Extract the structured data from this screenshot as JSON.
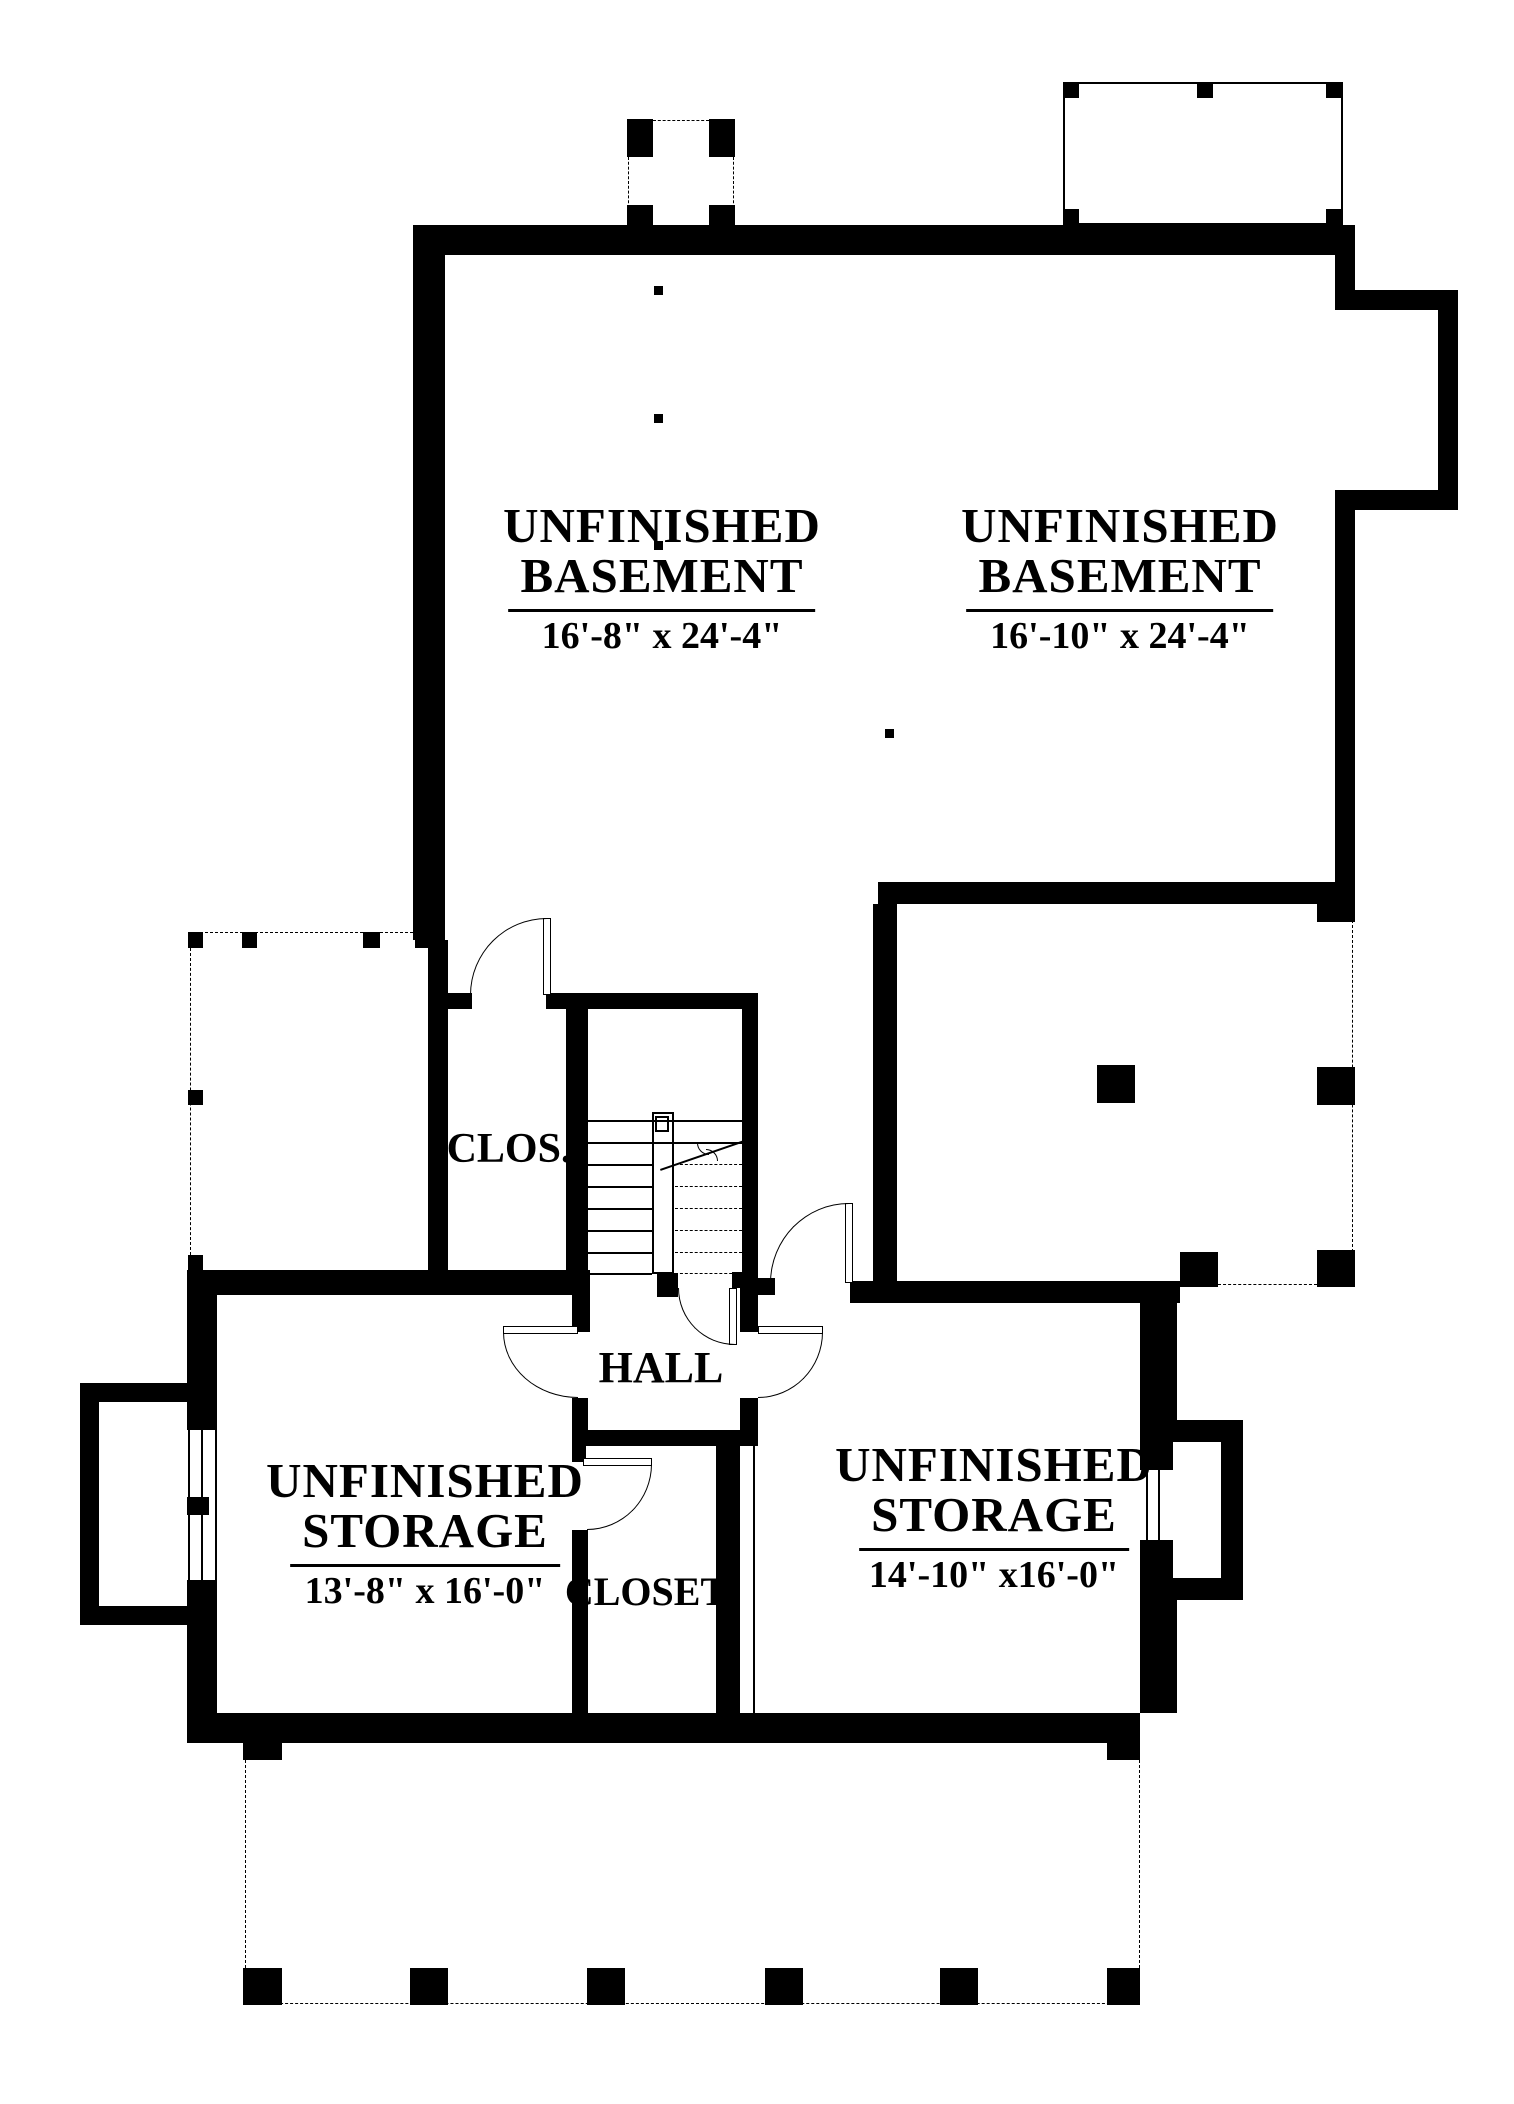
{
  "page": {
    "background": "#ffffff",
    "ink_color": "#000000",
    "type": "basement floor plan drawing"
  },
  "labels": [
    {
      "n": "room-label-basement-left",
      "cx": 662,
      "top": 501,
      "fs": 49,
      "line1": "UNFINISHED",
      "line2": "BASEMENT",
      "dims": "16'-8\" x 24'-4\""
    },
    {
      "n": "room-label-basement-right",
      "cx": 1120,
      "top": 501,
      "fs": 49,
      "line1": "UNFINISHED",
      "line2": "BASEMENT",
      "dims": "16'-10\" x 24'-4\""
    },
    {
      "n": "room-label-storage-left",
      "cx": 425,
      "top": 1456,
      "fs": 49,
      "line1": "UNFINISHED",
      "line2": "STORAGE",
      "dims": "13'-8\" x 16'-0\""
    },
    {
      "n": "room-label-storage-right",
      "cx": 994,
      "top": 1440,
      "fs": 49,
      "line1": "UNFINISHED",
      "line2": "STORAGE",
      "dims": "14'-10\" x16'-0\""
    }
  ],
  "small_labels": [
    {
      "n": "room-label-clos",
      "cx": 509,
      "top": 1125,
      "fs": 42,
      "text": "CLOS."
    },
    {
      "n": "room-label-hall",
      "cx": 661,
      "top": 1342,
      "fs": 44,
      "text": "HALL"
    },
    {
      "n": "room-label-closet",
      "cx": 646,
      "top": 1568,
      "fs": 40,
      "text": "CLOSET"
    }
  ],
  "shapes": [
    {
      "t": "wall",
      "n": "wall-top",
      "x": 413,
      "y": 225,
      "w": 942,
      "h": 30
    },
    {
      "t": "wall",
      "n": "wall-west-upper",
      "x": 413,
      "y": 225,
      "w": 32,
      "h": 715
    },
    {
      "t": "wall",
      "n": "wall-west-mid",
      "x": 428,
      "y": 940,
      "w": 20,
      "h": 353
    },
    {
      "t": "wall",
      "n": "wall-east-upper",
      "x": 1335,
      "y": 225,
      "w": 20,
      "h": 85
    },
    {
      "t": "wall",
      "n": "wall-east-bump-top",
      "x": 1335,
      "y": 290,
      "w": 123,
      "h": 20
    },
    {
      "t": "wall",
      "n": "wall-east-bump-right",
      "x": 1438,
      "y": 290,
      "w": 20,
      "h": 220
    },
    {
      "t": "wall",
      "n": "wall-east-bump-bottom",
      "x": 1352,
      "y": 490,
      "w": 106,
      "h": 20
    },
    {
      "t": "wall",
      "n": "wall-east-mid",
      "x": 1335,
      "y": 490,
      "w": 20,
      "h": 430
    },
    {
      "t": "wall",
      "n": "wall-basement-south",
      "x": 878,
      "y": 882,
      "w": 477,
      "h": 22
    },
    {
      "t": "wall",
      "n": "wall-lowerright-west",
      "x": 873,
      "y": 904,
      "w": 24,
      "h": 380
    },
    {
      "t": "wall",
      "n": "wall-storage-right-north",
      "x": 850,
      "y": 1281,
      "w": 330,
      "h": 22
    },
    {
      "t": "wall",
      "n": "wall-stair-top-a",
      "x": 428,
      "y": 993,
      "w": 44,
      "h": 16
    },
    {
      "t": "wall",
      "n": "wall-stair-top-b",
      "x": 546,
      "y": 993,
      "w": 212,
      "h": 16
    },
    {
      "t": "wall",
      "n": "wall-clos-east",
      "x": 566,
      "y": 1009,
      "w": 22,
      "h": 266
    },
    {
      "t": "wall",
      "n": "wall-stairwell-east",
      "x": 742,
      "y": 1009,
      "w": 16,
      "h": 266
    },
    {
      "t": "wall",
      "n": "wall-storage-left-north",
      "x": 187,
      "y": 1270,
      "w": 403,
      "h": 25
    },
    {
      "t": "wall",
      "n": "wall-stair-stub-mid",
      "x": 657,
      "y": 1273,
      "w": 21,
      "h": 24
    },
    {
      "t": "wall",
      "n": "wall-stair-stub-right",
      "x": 732,
      "y": 1272,
      "w": 26,
      "h": 16
    },
    {
      "t": "wall",
      "n": "wall-stub-hall-ne",
      "x": 758,
      "y": 1278,
      "w": 17,
      "h": 17
    },
    {
      "t": "wall",
      "n": "wall-hall-west-a",
      "x": 572,
      "y": 1295,
      "w": 18,
      "h": 37
    },
    {
      "t": "wall",
      "n": "wall-hall-west-b",
      "x": 572,
      "y": 1398,
      "w": 16,
      "h": 47
    },
    {
      "t": "wall",
      "n": "wall-closet-west-stub",
      "x": 572,
      "y": 1445,
      "w": 14,
      "h": 17
    },
    {
      "t": "wall",
      "n": "wall-closet-west",
      "x": 572,
      "y": 1530,
      "w": 16,
      "h": 185
    },
    {
      "t": "wall",
      "n": "wall-closet-north",
      "x": 580,
      "y": 1430,
      "w": 175,
      "h": 16
    },
    {
      "t": "wall",
      "n": "wall-closet-east",
      "x": 716,
      "y": 1446,
      "w": 24,
      "h": 270
    },
    {
      "t": "wall",
      "n": "wall-storage-right-west-a",
      "x": 740,
      "y": 1288,
      "w": 18,
      "h": 44
    },
    {
      "t": "wall",
      "n": "wall-storage-right-west-b",
      "x": 740,
      "y": 1398,
      "w": 18,
      "h": 48
    },
    {
      "t": "wall",
      "n": "wall-storage-right-east-a",
      "x": 1140,
      "y": 1303,
      "w": 37,
      "h": 117
    },
    {
      "t": "wall",
      "n": "wall-storage-right-east-b",
      "x": 1140,
      "y": 1600,
      "w": 37,
      "h": 113
    },
    {
      "t": "wall",
      "n": "wall-bottom",
      "x": 187,
      "y": 1713,
      "w": 953,
      "h": 30
    },
    {
      "t": "wall",
      "n": "wall-storage-left-west-a",
      "x": 187,
      "y": 1272,
      "w": 30,
      "h": 158
    },
    {
      "t": "wall",
      "n": "wall-storage-left-west-b",
      "x": 187,
      "y": 1580,
      "w": 30,
      "h": 133
    },
    {
      "t": "wall",
      "n": "wall-leftbump-top",
      "x": 80,
      "y": 1383,
      "w": 137,
      "h": 19
    },
    {
      "t": "wall",
      "n": "wall-leftbump-left",
      "x": 80,
      "y": 1383,
      "w": 19,
      "h": 242
    },
    {
      "t": "wall",
      "n": "wall-leftbump-bottom",
      "x": 80,
      "y": 1606,
      "w": 137,
      "h": 19
    },
    {
      "t": "wall",
      "n": "wall-rightbump-top",
      "x": 1140,
      "y": 1420,
      "w": 103,
      "h": 22
    },
    {
      "t": "wall",
      "n": "wall-rightbump-right",
      "x": 1221,
      "y": 1420,
      "w": 22,
      "h": 180
    },
    {
      "t": "wall",
      "n": "wall-rightbump-bottom",
      "x": 1140,
      "y": 1578,
      "w": 103,
      "h": 22
    },
    {
      "t": "wall",
      "n": "wall-rightbump-left-a",
      "x": 1140,
      "y": 1420,
      "w": 33,
      "h": 50
    },
    {
      "t": "wall",
      "n": "wall-rightbump-left-b",
      "x": 1140,
      "y": 1540,
      "w": 33,
      "h": 60
    },
    {
      "t": "wall",
      "n": "window-mullion-left",
      "x": 187,
      "y": 1497,
      "w": 22,
      "h": 18
    },
    {
      "t": "post",
      "n": "stoop-post-nw",
      "x": 627,
      "y": 119,
      "w": 26,
      "h": 38
    },
    {
      "t": "post",
      "n": "stoop-post-ne",
      "x": 709,
      "y": 119,
      "w": 26,
      "h": 38
    },
    {
      "t": "post",
      "n": "stoop-post-sw",
      "x": 627,
      "y": 205,
      "w": 26,
      "h": 22
    },
    {
      "t": "post",
      "n": "stoop-post-se",
      "x": 709,
      "y": 205,
      "w": 26,
      "h": 22
    },
    {
      "t": "post",
      "n": "trporch-post-nw",
      "x": 1063,
      "y": 82,
      "w": 16,
      "h": 16
    },
    {
      "t": "post",
      "n": "trporch-post-n",
      "x": 1197,
      "y": 82,
      "w": 16,
      "h": 16
    },
    {
      "t": "post",
      "n": "trporch-post-ne",
      "x": 1326,
      "y": 82,
      "w": 16,
      "h": 16
    },
    {
      "t": "post",
      "n": "trporch-post-sw",
      "x": 1063,
      "y": 209,
      "w": 16,
      "h": 16
    },
    {
      "t": "post",
      "n": "trporch-post-se",
      "x": 1326,
      "y": 209,
      "w": 16,
      "h": 16
    },
    {
      "t": "post",
      "n": "lporch-post-1",
      "x": 188,
      "y": 932,
      "w": 15,
      "h": 16
    },
    {
      "t": "post",
      "n": "lporch-post-2",
      "x": 242,
      "y": 932,
      "w": 15,
      "h": 16
    },
    {
      "t": "post",
      "n": "lporch-post-3",
      "x": 363,
      "y": 932,
      "w": 17,
      "h": 16
    },
    {
      "t": "post",
      "n": "lporch-post-4",
      "x": 415,
      "y": 932,
      "w": 15,
      "h": 16
    },
    {
      "t": "post",
      "n": "lporch-post-5",
      "x": 188,
      "y": 1090,
      "w": 15,
      "h": 15
    },
    {
      "t": "post",
      "n": "lporch-post-6",
      "x": 188,
      "y": 1255,
      "w": 15,
      "h": 17
    },
    {
      "t": "post",
      "n": "rporch-post-n",
      "x": 1317,
      "y": 898,
      "w": 38,
      "h": 24
    },
    {
      "t": "post",
      "n": "rporch-post-e",
      "x": 1317,
      "y": 1067,
      "w": 38,
      "h": 38
    },
    {
      "t": "post",
      "n": "rporch-post-se",
      "x": 1317,
      "y": 1250,
      "w": 38,
      "h": 37
    },
    {
      "t": "post",
      "n": "rporch-post-s",
      "x": 1180,
      "y": 1252,
      "w": 38,
      "h": 35
    },
    {
      "t": "post",
      "n": "column-post",
      "x": 1097,
      "y": 1065,
      "w": 38,
      "h": 38
    },
    {
      "t": "post",
      "n": "bporch-post-nw",
      "x": 243,
      "y": 1743,
      "w": 39,
      "h": 17
    },
    {
      "t": "post",
      "n": "bporch-post-ne",
      "x": 1107,
      "y": 1743,
      "w": 33,
      "h": 17
    },
    {
      "t": "post",
      "n": "bporch-post-s1",
      "x": 243,
      "y": 1968,
      "w": 39,
      "h": 37
    },
    {
      "t": "post",
      "n": "bporch-post-s2",
      "x": 410,
      "y": 1968,
      "w": 38,
      "h": 37
    },
    {
      "t": "post",
      "n": "bporch-post-s3",
      "x": 587,
      "y": 1968,
      "w": 38,
      "h": 37
    },
    {
      "t": "post",
      "n": "bporch-post-s4",
      "x": 765,
      "y": 1968,
      "w": 38,
      "h": 37
    },
    {
      "t": "post",
      "n": "bporch-post-s5",
      "x": 940,
      "y": 1968,
      "w": 38,
      "h": 37
    },
    {
      "t": "post",
      "n": "bporch-post-s6",
      "x": 1107,
      "y": 1968,
      "w": 33,
      "h": 37
    },
    {
      "t": "dot",
      "n": "column-dot-1",
      "x": 654,
      "y": 286,
      "w": 9,
      "h": 9
    },
    {
      "t": "dot",
      "n": "column-dot-2",
      "x": 654,
      "y": 414,
      "w": 9,
      "h": 9
    },
    {
      "t": "dot",
      "n": "column-dot-3",
      "x": 654,
      "y": 541,
      "w": 9,
      "h": 9
    },
    {
      "t": "dot",
      "n": "column-dot-4",
      "x": 885,
      "y": 729,
      "w": 9,
      "h": 9
    },
    {
      "t": "dashh",
      "n": "stoop-dash-top",
      "x": 653,
      "y": 120,
      "w": 56,
      "h": 0
    },
    {
      "t": "dashv",
      "n": "stoop-dash-left",
      "x": 628,
      "y": 157,
      "w": 0,
      "h": 51
    },
    {
      "t": "dashv",
      "n": "stoop-dash-right",
      "x": 733,
      "y": 157,
      "w": 0,
      "h": 51
    },
    {
      "t": "dashh",
      "n": "lporch-dash-top",
      "x": 190,
      "y": 932,
      "w": 238,
      "h": 0
    },
    {
      "t": "dashv",
      "n": "lporch-dash-left",
      "x": 190,
      "y": 948,
      "w": 0,
      "h": 307
    },
    {
      "t": "dashv",
      "n": "rporch-dash-east",
      "x": 1352,
      "y": 920,
      "w": 0,
      "h": 332
    },
    {
      "t": "dashh",
      "n": "rporch-dash-south",
      "x": 1218,
      "y": 1284,
      "w": 99,
      "h": 0
    },
    {
      "t": "dashv",
      "n": "bporch-dash-west",
      "x": 245,
      "y": 1760,
      "w": 0,
      "h": 243
    },
    {
      "t": "dashh",
      "n": "bporch-dash-south",
      "x": 245,
      "y": 2003,
      "w": 895,
      "h": 0
    },
    {
      "t": "dashv",
      "n": "bporch-dash-east",
      "x": 1139,
      "y": 1760,
      "w": 0,
      "h": 208
    },
    {
      "t": "thinrect",
      "n": "trporch-outline",
      "x": 1063,
      "y": 82,
      "w": 280,
      "h": 143
    },
    {
      "t": "thinrect",
      "n": "stair-rail",
      "x": 652,
      "y": 1112,
      "w": 22,
      "h": 162
    },
    {
      "t": "thinrect",
      "n": "stair-rail-cap",
      "x": 655,
      "y": 1116,
      "w": 14,
      "h": 16
    },
    {
      "t": "lineh",
      "n": "stair-tread-1",
      "x": 588,
      "y": 1120,
      "w": 154,
      "h": 0
    },
    {
      "t": "lineh",
      "n": "stair-tread-2",
      "x": 588,
      "y": 1142,
      "w": 154,
      "h": 0
    },
    {
      "t": "lineh",
      "n": "stair-tread-3",
      "x": 588,
      "y": 1164,
      "w": 64,
      "h": 0
    },
    {
      "t": "lineh",
      "n": "stair-tread-4",
      "x": 588,
      "y": 1186,
      "w": 64,
      "h": 0
    },
    {
      "t": "lineh",
      "n": "stair-tread-5",
      "x": 588,
      "y": 1208,
      "w": 64,
      "h": 0
    },
    {
      "t": "lineh",
      "n": "stair-tread-6",
      "x": 588,
      "y": 1230,
      "w": 64,
      "h": 0
    },
    {
      "t": "lineh",
      "n": "stair-tread-7",
      "x": 588,
      "y": 1252,
      "w": 64,
      "h": 0
    },
    {
      "t": "lineh",
      "n": "stair-tread-8",
      "x": 588,
      "y": 1273,
      "w": 64,
      "h": 0
    },
    {
      "t": "dashh",
      "n": "stair-tread-hidden-1",
      "x": 675,
      "y": 1164,
      "w": 67,
      "h": 0
    },
    {
      "t": "dashh",
      "n": "stair-tread-hidden-2",
      "x": 675,
      "y": 1186,
      "w": 67,
      "h": 0
    },
    {
      "t": "dashh",
      "n": "stair-tread-hidden-3",
      "x": 675,
      "y": 1208,
      "w": 67,
      "h": 0
    },
    {
      "t": "dashh",
      "n": "stair-tread-hidden-4",
      "x": 675,
      "y": 1230,
      "w": 67,
      "h": 0
    },
    {
      "t": "dashh",
      "n": "stair-tread-hidden-5",
      "x": 675,
      "y": 1252,
      "w": 67,
      "h": 0
    },
    {
      "t": "dashh",
      "n": "stair-tread-hidden-6",
      "x": 675,
      "y": 1273,
      "w": 67,
      "h": 0
    },
    {
      "t": "diag",
      "n": "stair-break-line",
      "x": 660,
      "y": 1169,
      "len": 89,
      "rot": -19
    },
    {
      "t": "arc-bl",
      "n": "stair-break-squiggle-a",
      "x": 697,
      "y": 1143,
      "w": 12,
      "h": 12
    },
    {
      "t": "arc-tr",
      "n": "stair-break-squiggle-b",
      "x": 706,
      "y": 1149,
      "w": 12,
      "h": 12
    },
    {
      "t": "linev",
      "n": "window-left-line-1",
      "x": 188,
      "y": 1430,
      "w": 0,
      "h": 150
    },
    {
      "t": "linev",
      "n": "window-left-line-2",
      "x": 201,
      "y": 1430,
      "w": 0,
      "h": 150
    },
    {
      "t": "linev",
      "n": "window-left-line-3",
      "x": 215,
      "y": 1430,
      "w": 0,
      "h": 150
    },
    {
      "t": "linev",
      "n": "window-right-line-1",
      "x": 1146,
      "y": 1470,
      "w": 0,
      "h": 70
    },
    {
      "t": "linev",
      "n": "window-right-line-2",
      "x": 1158,
      "y": 1470,
      "w": 0,
      "h": 70
    },
    {
      "t": "linev",
      "n": "closet-east-face-line",
      "x": 753,
      "y": 1446,
      "w": 0,
      "h": 267
    },
    {
      "t": "leaf",
      "n": "door-leaf-clos-basement",
      "x": 543,
      "y": 918,
      "w": 8,
      "h": 77
    },
    {
      "t": "arc-tl",
      "n": "door-arc-clos-basement",
      "x": 470,
      "y": 918,
      "w": 77,
      "h": 77
    },
    {
      "t": "leaf",
      "n": "door-leaf-lowerright-room",
      "x": 845,
      "y": 1203,
      "w": 8,
      "h": 80
    },
    {
      "t": "arc-tl",
      "n": "door-arc-lowerright-room",
      "x": 770,
      "y": 1203,
      "w": 79,
      "h": 80
    },
    {
      "t": "leaf",
      "n": "door-leaf-understair",
      "x": 729,
      "y": 1288,
      "w": 8,
      "h": 57
    },
    {
      "t": "arc-bl",
      "n": "door-arc-understair",
      "x": 678,
      "y": 1288,
      "w": 57,
      "h": 57
    },
    {
      "t": "leaf",
      "n": "door-leaf-storage-left",
      "x": 503,
      "y": 1326,
      "w": 75,
      "h": 8
    },
    {
      "t": "arc-bl",
      "n": "door-arc-storage-left",
      "x": 503,
      "y": 1332,
      "w": 75,
      "h": 66
    },
    {
      "t": "leaf",
      "n": "door-leaf-storage-right",
      "x": 758,
      "y": 1326,
      "w": 65,
      "h": 8
    },
    {
      "t": "arc-br",
      "n": "door-arc-storage-right",
      "x": 758,
      "y": 1332,
      "w": 65,
      "h": 66
    },
    {
      "t": "leaf",
      "n": "door-leaf-closet",
      "x": 583,
      "y": 1458,
      "w": 69,
      "h": 8
    },
    {
      "t": "arc-br",
      "n": "door-arc-closet",
      "x": 587,
      "y": 1464,
      "w": 65,
      "h": 66
    }
  ]
}
